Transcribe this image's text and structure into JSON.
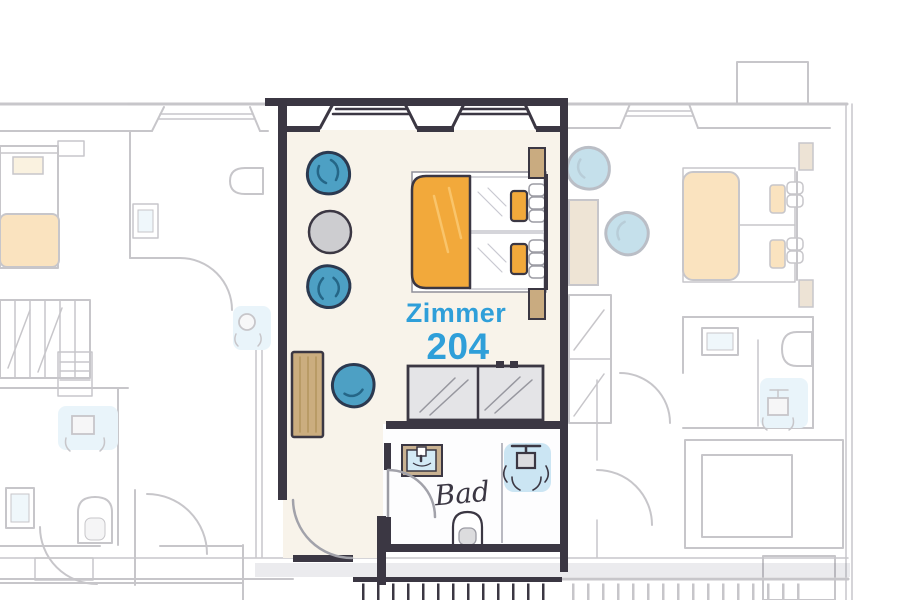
{
  "diagram": {
    "type": "hotel-floor-plan",
    "room": {
      "name_label": "Zimmer",
      "number": "204",
      "bathroom_label": "Bad"
    },
    "furniture_main_room": [
      "armchair",
      "armchair",
      "round-side-table",
      "desk",
      "desk-chair",
      "double-bed",
      "orange-duvet",
      "orange-pillows",
      "white-pillows",
      "nightstand",
      "nightstand",
      "mirror-wardrobe",
      "washbasin",
      "shower",
      "toilet",
      "entry-door",
      "bathroom-door",
      "window-bay",
      "window-bay"
    ],
    "neighbor_areas": [
      "left-room-faded",
      "right-room-faded",
      "corridor",
      "stairs"
    ]
  },
  "colors": {
    "wall_dark": "#3b3743",
    "accent_text_blue": "#2f9fd9",
    "duvet_orange": "#f2a93b",
    "pillow_orange": "#f2a93b",
    "armchair_blue": "#4da0c4",
    "armchair_outline": "#2b3950",
    "wood_tan": "#cbad7f",
    "nightstand_tan": "#c9ab80",
    "floor_cream": "#f8f3ea",
    "water_blue": "#bedff0",
    "basin_blue": "#d3eaf5",
    "mirror_gray": "#e4e4e7",
    "table_gray": "#cdcdd0",
    "faded_line": "#55515e",
    "ink_dark": "#3b3743"
  }
}
